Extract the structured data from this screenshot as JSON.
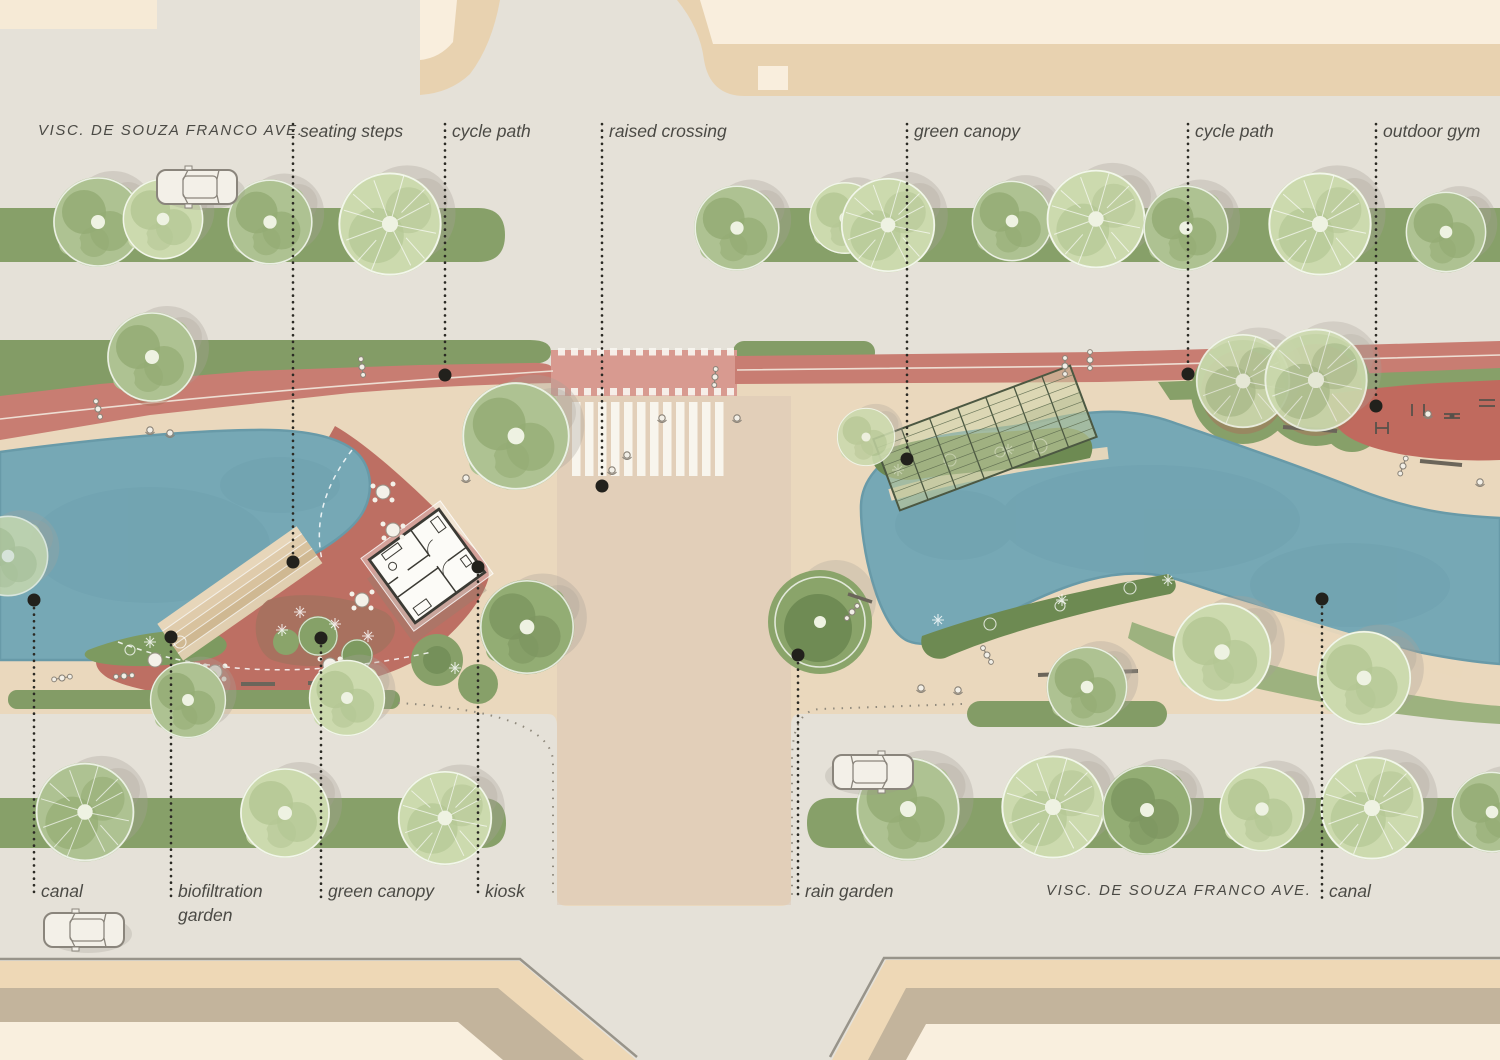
{
  "plan": {
    "type": "urban-landscape-masterplan",
    "streets": {
      "top": "VISC. DE SOUZA FRANCO AVE.",
      "bottom": "VISC. DE SOUZA FRANCO AVE."
    },
    "annotations": {
      "top": [
        {
          "text": "seating steps"
        },
        {
          "text": "cycle path"
        },
        {
          "text": "raised crossing"
        },
        {
          "text": "green canopy"
        },
        {
          "text": "cycle path"
        },
        {
          "text": "outdoor gym"
        }
      ],
      "bottom": [
        {
          "text": "canal"
        },
        {
          "text": "biofiltration garden"
        },
        {
          "text": "green canopy"
        },
        {
          "text": "kiosk"
        },
        {
          "text": "rain garden"
        },
        {
          "text": "canal"
        }
      ]
    },
    "features": [
      "canal",
      "seating steps",
      "cycle path",
      "raised crossing",
      "green canopy",
      "outdoor gym",
      "biofiltration garden",
      "kiosk",
      "rain garden"
    ]
  },
  "colors": {
    "sidewalk": "#e5e1d8",
    "esplanade": "#ead8bd",
    "road_tint": "#dac6b3",
    "building_tan": "#e8d2b0",
    "building_cream": "#f9eedd",
    "building_band": "#c3b49c",
    "lawn": "#87a069",
    "lawn_dark": "#6d8a52",
    "bank_green": "#9db27f",
    "water": "#76a8b5",
    "cycle_red": "#c87d72",
    "crossing_red": "#d89a90",
    "plaza_red": "#bd6f63",
    "gym_red": "#c06a5e",
    "planting_brown": "#a5715e",
    "stripe_white": "#faf8f2",
    "kiosk_white": "#fcfbf7",
    "outline_dark": "#3b3a34",
    "label_text": "#4b4a45",
    "leader_dot": "#22211c"
  }
}
